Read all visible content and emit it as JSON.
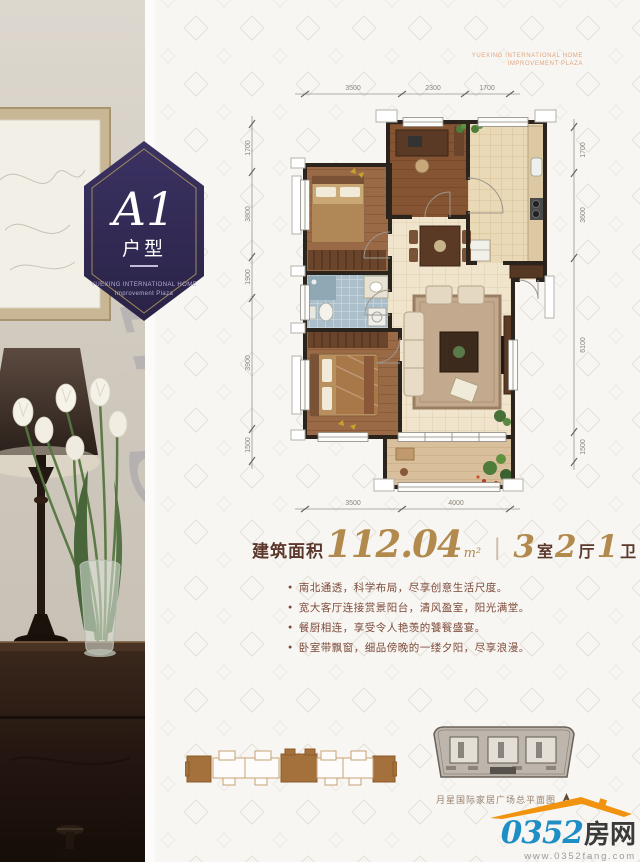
{
  "badge": {
    "code": "A1",
    "type_label": "户型",
    "org_line1": "YUEXING INTERNATIONAL HOME",
    "org_line2": "Improvement Plaza"
  },
  "plan_watermark": {
    "line1": "YUEXING INTERNATIONAL HOME",
    "line2": "IMPROVEMENT PLAZA"
  },
  "photo_watermark": "ing",
  "floor_plan": {
    "dimensions": {
      "top": [
        "3500",
        "2300",
        "1700"
      ],
      "bottom": [
        "3500",
        "4000"
      ],
      "left": [
        "1700",
        "3800",
        "1900",
        "3900",
        "1500"
      ],
      "right": [
        "1700",
        "3600",
        "6100",
        "1500"
      ]
    }
  },
  "area": {
    "label": "建筑面积",
    "value": "112.04",
    "unit": "m²",
    "divider": "|",
    "rooms": [
      {
        "count": "3",
        "type": "室"
      },
      {
        "count": "2",
        "type": "厅"
      },
      {
        "count": "1",
        "type": "卫"
      }
    ]
  },
  "features": [
    "南北通透，科学布局，尽享创意生活尺度。",
    "宽大客厅连接赏景阳台，清风盈室，阳光满堂。",
    "餐厨相连，享受令人艳羡的饕餮盛宴。",
    "卧室带飘窗，细品傍晚的一缕夕阳，尽享浪漫。"
  ],
  "site_plan": {
    "caption": "月星国际家居广场总平面图"
  },
  "logo": {
    "number": "0352",
    "name": "房网",
    "url": "www.0352fang.com"
  },
  "colors": {
    "accent_gold": "#b28a4e",
    "text_maroon": "#5c372b",
    "badge_purple": "#332b55",
    "logo_blue": "#1e8fc6",
    "logo_orange": "#f1930f",
    "highlight_brown": "#a4713d"
  }
}
